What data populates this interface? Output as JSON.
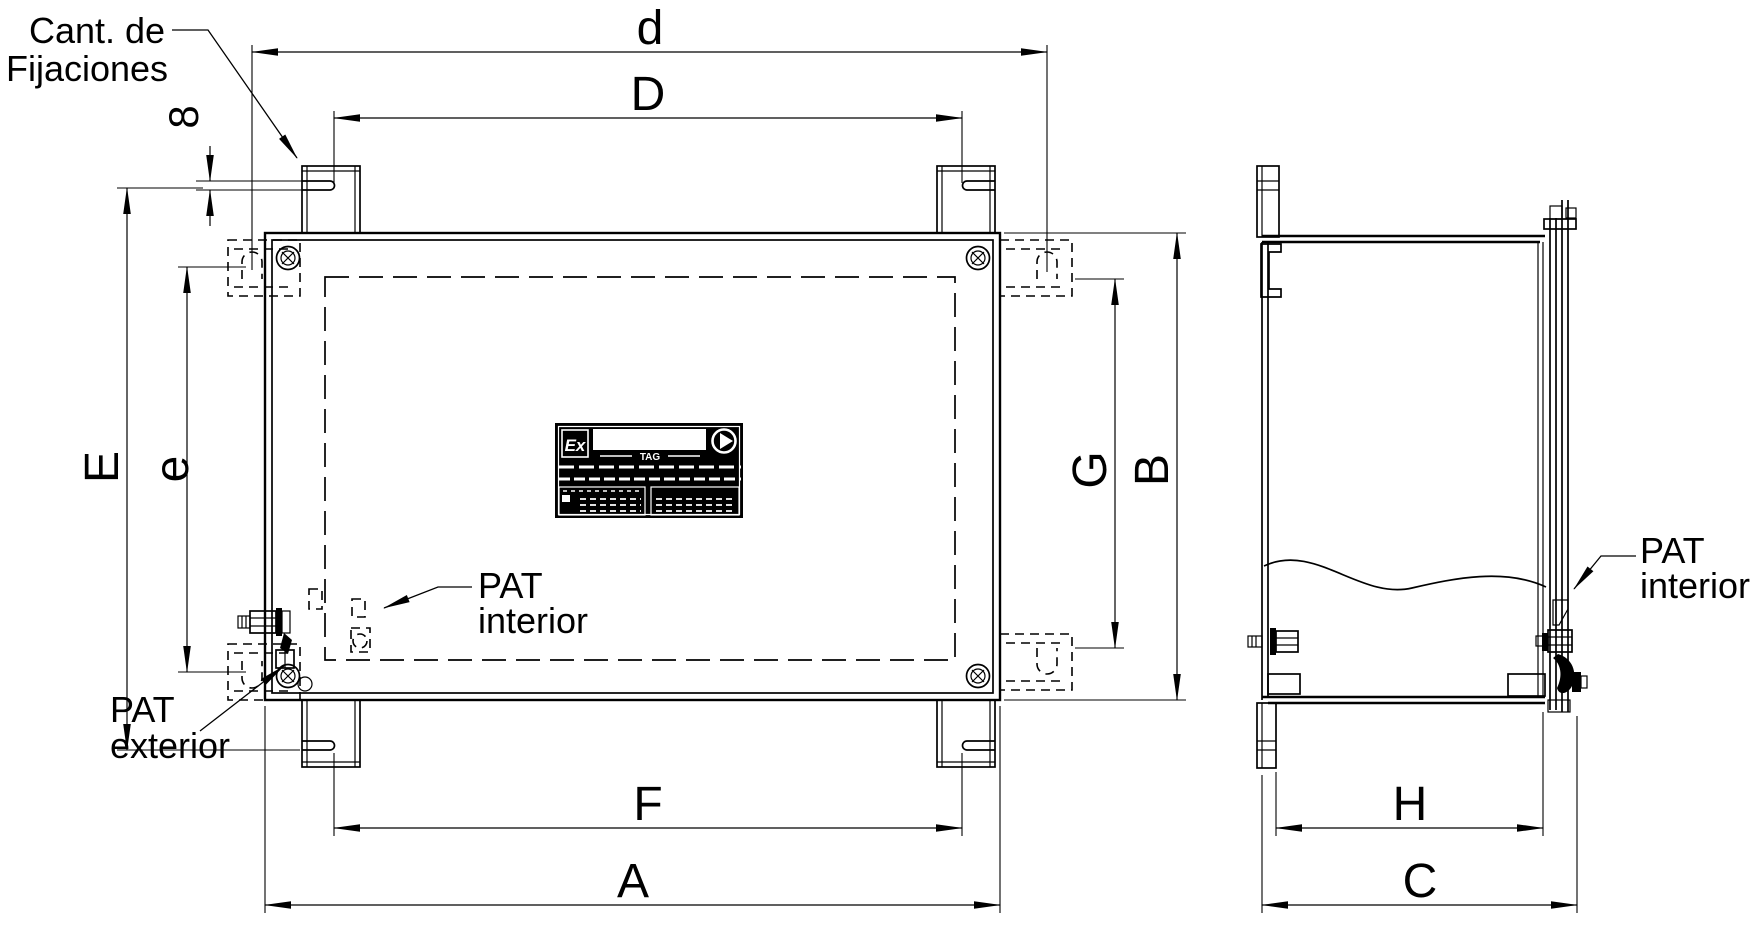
{
  "drawing": {
    "title": "enclosure-mounting-dimensions",
    "background_color": "#ffffff",
    "line_color": "#000000",
    "dimensions": {
      "d": "d",
      "D": "D",
      "slot_width": "8",
      "E": "E",
      "e": "e",
      "G": "G",
      "B": "B",
      "F": "F",
      "A": "A",
      "H": "H",
      "C": "C"
    },
    "labels": {
      "fixings_line1": "Cant. de",
      "fixings_line2": "Fijaciones",
      "pat_interior_front_line1": "PAT",
      "pat_interior_front_line2": "interior",
      "pat_exterior_line1": "PAT",
      "pat_exterior_line2": "exterior",
      "pat_interior_side_line1": "PAT",
      "pat_interior_side_line2": "interior"
    },
    "nameplate": {
      "ex_mark": "Ex",
      "tag": "TAG"
    }
  }
}
